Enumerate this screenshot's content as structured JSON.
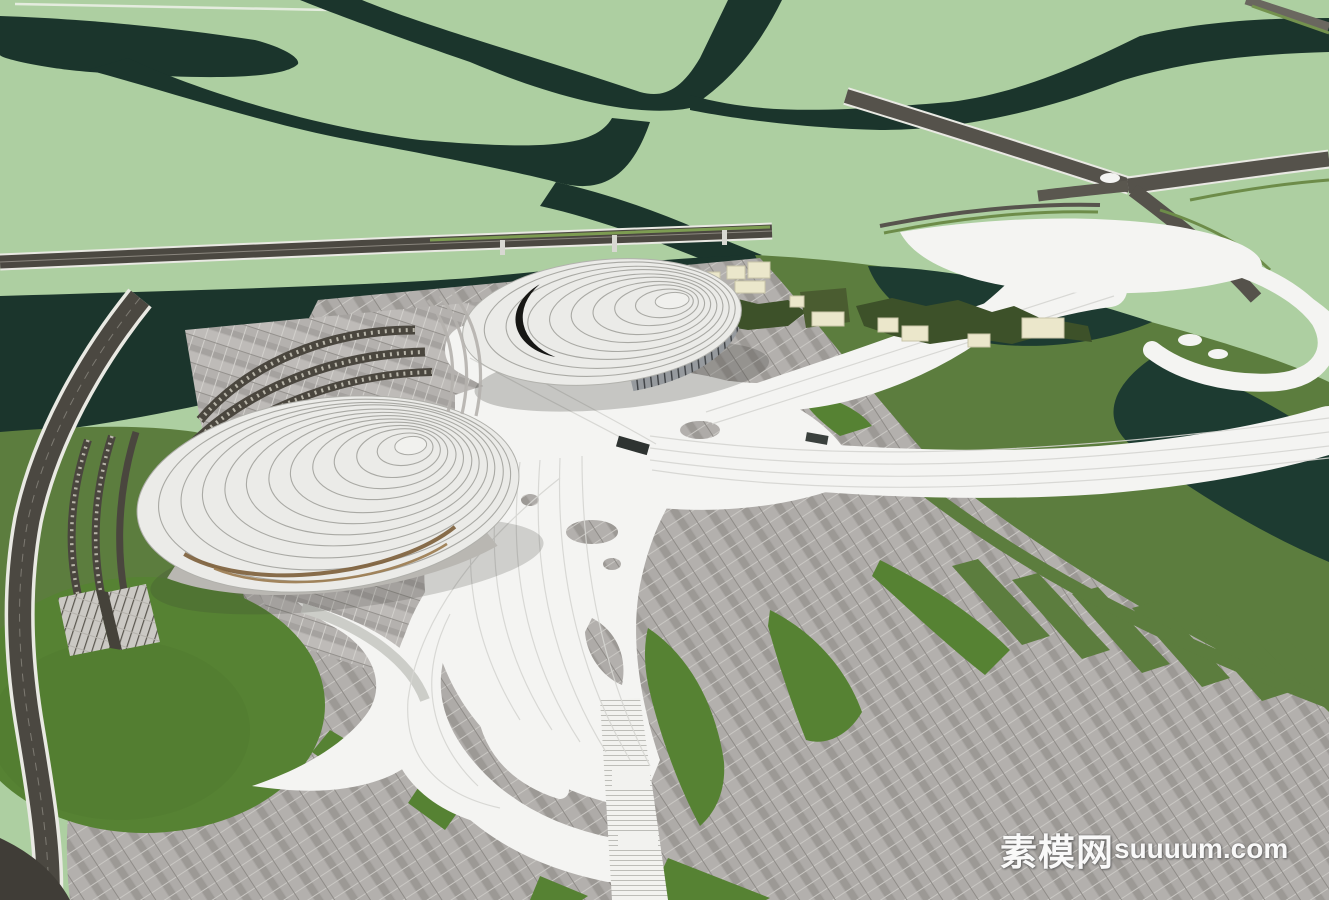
{
  "watermark": {
    "cn": "素模网",
    "latin": "suuuum.com"
  },
  "palette": {
    "field_green": "#adcfa1",
    "channel_dark": "#1b352c",
    "water_dark": "#1d3b31",
    "grass_green": "#5c7d3e",
    "lawn_green": "#568233",
    "tree_olive": "#3d5129",
    "tree_roof_olive": "#4a5c30",
    "building_cream": "#ebe7cb",
    "paving_gray": "#a8a5a2",
    "paving_light": "#b4b1ae",
    "ribbon_white": "#f4f4f2",
    "roof_white": "#ebebe8",
    "contour_gray": "#a9a9a4",
    "louver_brown": "#7c5e39",
    "asphalt_dark": "#4b4841",
    "glazing_gray": "#8e9195",
    "watermark_white": "#ffffff"
  }
}
